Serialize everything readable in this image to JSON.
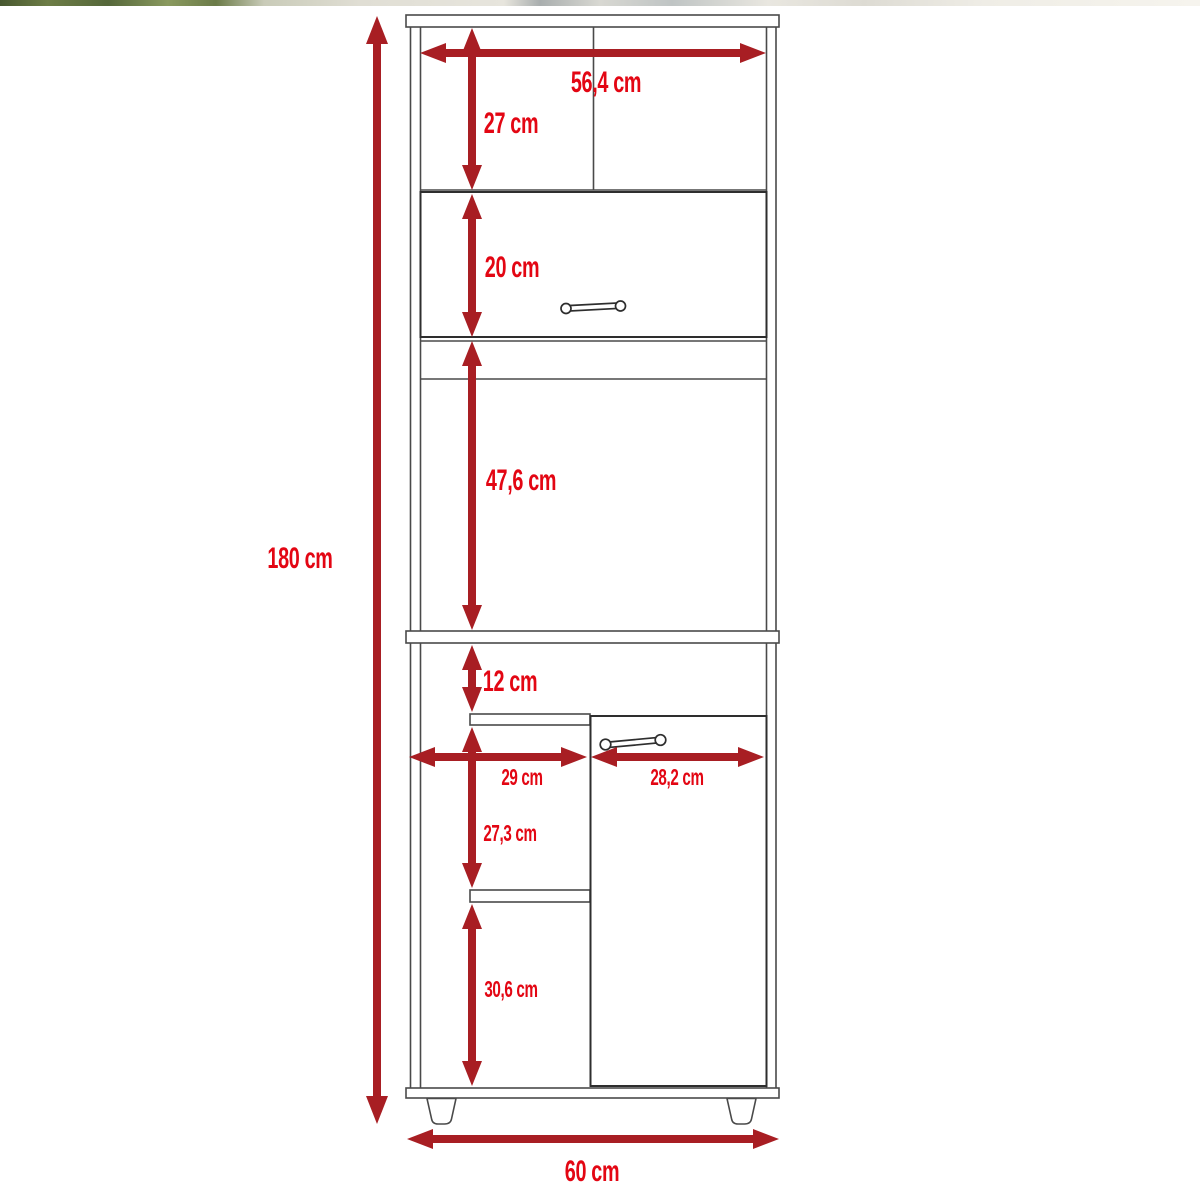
{
  "diagram": {
    "type": "furniture-dimension-diagram",
    "subject": "tall kitchen pantry cabinet front view with dimension arrows",
    "unit": "cm",
    "labels": {
      "total_height": {
        "text": "180 cm"
      },
      "top_width": {
        "text": "56,4 cm"
      },
      "top_section_height": {
        "text": "27 cm"
      },
      "flap_door_height": {
        "text": "20 cm"
      },
      "open_section_height": {
        "text": "47,6 cm"
      },
      "niche_height": {
        "text": "12 cm"
      },
      "left_compartment_width": {
        "text": "29 cm"
      },
      "right_door_width": {
        "text": "28,2 cm"
      },
      "middle_shelf_height": {
        "text": "27,3 cm"
      },
      "bottom_shelf_height": {
        "text": "30,6 cm"
      },
      "base_width": {
        "text": "60 cm"
      }
    },
    "colors": {
      "arrow": "#a81e23",
      "label": "#e30613",
      "line": "#4a4a4a",
      "door_line": "#2e2e2e",
      "background": "#ffffff"
    }
  }
}
